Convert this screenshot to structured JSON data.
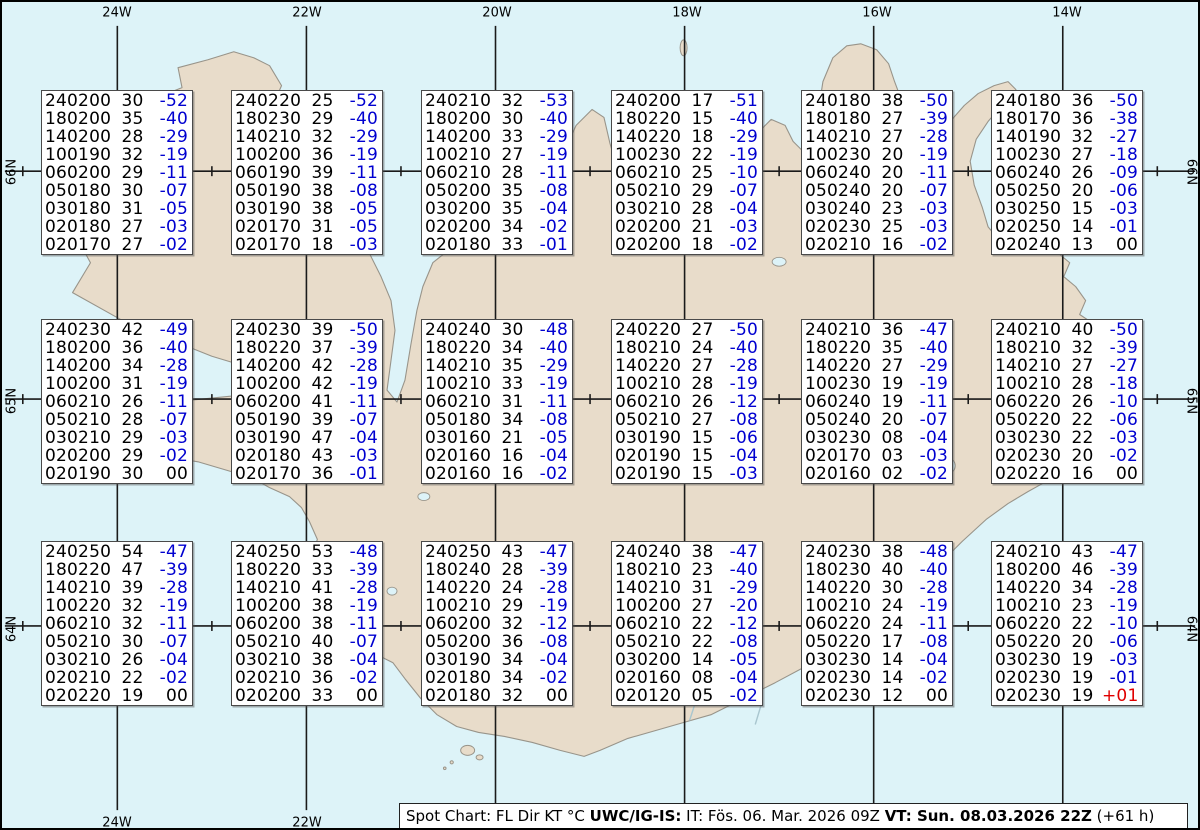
{
  "map": {
    "lon_labels": [
      "24W",
      "22W",
      "20W",
      "18W",
      "16W",
      "14W"
    ],
    "lat_labels": [
      "66N",
      "65N",
      "64N"
    ],
    "colors": {
      "ocean": "#ddf3f8",
      "land": "#e8dcca",
      "coast": "#98948a",
      "grid": "#1a1a1a",
      "temp_negative": "#0000d0",
      "temp_positive": "#e00000",
      "text": "#000000"
    }
  },
  "spots": [
    [
      "240200 30 -52",
      "180200 35 -40",
      "140200 28 -29",
      "100190 32 -19",
      "060200 29 -11",
      "050180 30 -07",
      "030180 31 -05",
      "020180 27 -03",
      "020170 27 -02"
    ],
    [
      "240220 25 -52",
      "180230 29 -40",
      "140210 32 -29",
      "100200 36 -19",
      "060190 39 -11",
      "050190 38 -08",
      "030190 38 -05",
      "020170 31 -05",
      "020170 18 -03"
    ],
    [
      "240210 32 -53",
      "180200 30 -40",
      "140200 33 -29",
      "100210 27 -19",
      "060210 28 -11",
      "050200 35 -08",
      "030200 35 -04",
      "020200 34 -02",
      "020180 33 -01"
    ],
    [
      "240200 17 -51",
      "180220 15 -40",
      "140220 18 -29",
      "100230 22 -19",
      "060210 25 -10",
      "050210 29 -07",
      "030210 28 -04",
      "020200 21 -03",
      "020200 18 -02"
    ],
    [
      "240180 38 -50",
      "180180 27 -39",
      "140210 27 -28",
      "100230 20 -19",
      "060240 20 -11",
      "050240 20 -07",
      "030240 23 -03",
      "020230 25 -03",
      "020210 16 -02"
    ],
    [
      "240180 36 -50",
      "180170 36 -38",
      "140190 32 -27",
      "100230 27 -18",
      "060240 26 -09",
      "050250 20 -06",
      "030250 15 -03",
      "020250 14 -01",
      "020240 13 00"
    ],
    [
      "240230 42 -49",
      "180200 36 -40",
      "140200 34 -28",
      "100200 31 -19",
      "060210 26 -11",
      "050210 28 -07",
      "030210 29 -03",
      "020200 29 -02",
      "020190 30 00"
    ],
    [
      "240230 39 -50",
      "180220 37 -39",
      "140200 42 -28",
      "100200 42 -19",
      "060200 41 -11",
      "050190 39 -07",
      "030190 47 -04",
      "020180 43 -03",
      "020170 36 -01"
    ],
    [
      "240240 30 -48",
      "180220 34 -40",
      "140210 35 -29",
      "100210 33 -19",
      "060210 31 -11",
      "050180 34 -08",
      "030160 21 -05",
      "020160 16 -04",
      "020160 16 -02"
    ],
    [
      "240220 27 -50",
      "180210 24 -40",
      "140220 27 -28",
      "100210 28 -19",
      "060210 26 -12",
      "050210 27 -08",
      "030190 15 -06",
      "020190 15 -04",
      "020190 15 -03"
    ],
    [
      "240210 36 -47",
      "180220 35 -40",
      "140220 27 -29",
      "100230 19 -19",
      "060240 19 -11",
      "050240 20 -07",
      "030230 08 -04",
      "020170 03 -03",
      "020160 02 -02"
    ],
    [
      "240210 40 -50",
      "180210 32 -39",
      "140210 27 -27",
      "100210 28 -18",
      "060220 26 -10",
      "050220 22 -06",
      "030230 22 -03",
      "020230 20 -02",
      "020220 16 00"
    ],
    [
      "240250 54 -47",
      "180220 47 -39",
      "140210 39 -28",
      "100220 32 -19",
      "060210 32 -11",
      "050210 30 -07",
      "030210 26 -04",
      "020210 22 -02",
      "020220 19 00"
    ],
    [
      "240250 53 -48",
      "180220 33 -39",
      "140210 41 -28",
      "100200 38 -19",
      "060200 38 -11",
      "050210 40 -07",
      "030210 38 -04",
      "020210 36 -02",
      "020200 33 00"
    ],
    [
      "240250 43 -47",
      "180240 28 -39",
      "140220 24 -28",
      "100210 29 -19",
      "060200 32 -12",
      "050200 36 -08",
      "030190 34 -04",
      "020180 34 -02",
      "020180 32 00"
    ],
    [
      "240240 38 -47",
      "180210 23 -40",
      "140210 31 -29",
      "100200 27 -20",
      "060210 22 -12",
      "050210 22 -08",
      "030200 14 -05",
      "020160 08 -04",
      "020120 05 -02"
    ],
    [
      "240230 38 -48",
      "180230 40 -40",
      "140220 30 -28",
      "100210 24 -19",
      "060220 24 -11",
      "050220 17 -08",
      "030230 14 -04",
      "020230 14 -02",
      "020230 12 00"
    ],
    [
      "240210 43 -47",
      "180200 46 -39",
      "140220 34 -28",
      "100210 23 -19",
      "060220 22 -10",
      "050220 20 -06",
      "030230 19 -03",
      "020230 19 -01",
      "020230 19 +01"
    ]
  ],
  "caption": {
    "segments": [
      {
        "text": "Spot Chart: FL Dir KT °C ",
        "bold": false
      },
      {
        "text": "UWC/IG-IS:",
        "bold": true
      },
      {
        "text": " IT: Fös. 06. Mar. 2026 09Z ",
        "bold": false
      },
      {
        "text": "VT: Sun. 08.03.2026 22Z",
        "bold": true
      },
      {
        "text": " (+61 h)",
        "bold": false
      }
    ]
  }
}
